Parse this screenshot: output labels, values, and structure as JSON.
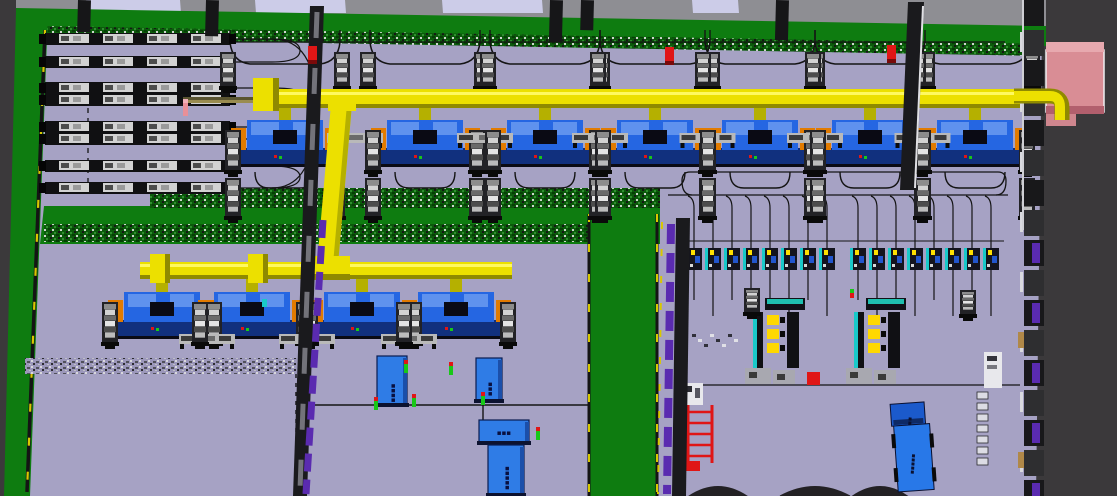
{
  "viewport": {
    "kind": "factory-3d-layout-render",
    "background": "#3b393b"
  },
  "labels": {
    "storage_box_1": "▪▪▪▪",
    "storage_box_2": "▪▪▪",
    "storage_box_3": "▪▪▪",
    "storage_box_4": "▪▪▪▪▪",
    "truck_cab": "▪▪",
    "truck_body": "▪▪▪▪▪"
  },
  "palette": {
    "bg": "#3b393b",
    "floor": "#a6a2c4",
    "green": "#0e7c10",
    "hedge": "#0b5a0b",
    "roof": "#8e8e93",
    "skylight": "#cccce8",
    "wallDark": "#1a1a1d",
    "wallLite": "#d9d9de",
    "purple": "#5a2bb0",
    "pipe": "#ece000",
    "pipeShade": "#8f8a00",
    "pipeDark": "#b5b000",
    "beam": "#9a8c50",
    "blue": "#2566e2",
    "blueLite": "#5f92ee",
    "blueDark": "#11307e",
    "navy": "#0a0a14",
    "orange": "#e27b00",
    "silver": "#d2d2d2",
    "silverMid": "#8c8c8c",
    "silverDark": "#4c4c4c",
    "red": "#e01616",
    "pinkFace": "#d98d95",
    "pinkTop": "#e7a9af",
    "pinkSide": "#b25f6d",
    "teal": "#1fbfae",
    "cyan": "#19c9c9",
    "track": "#141414",
    "yellowDash": "#d8c800",
    "boxBlue": "#2f7ce6",
    "boxBlueDark": "#1b4faa",
    "truckBlue": "#2878e8",
    "truckCab": "#1b5acc",
    "tan": "#b08848",
    "gray": "#73737a",
    "mound": "#232124",
    "figGreen": "#18c818",
    "figPink": "#e89098",
    "white": "#e8e8ec"
  },
  "scene": {
    "skylights": [
      [
        86,
        94
      ],
      [
        255,
        90
      ],
      [
        442,
        100
      ],
      [
        692,
        46
      ]
    ],
    "columns": [
      [
        78,
        32
      ],
      [
        206,
        36
      ],
      [
        550,
        42
      ],
      [
        581,
        30
      ],
      [
        776,
        40
      ]
    ],
    "line1": {
      "x1": 183,
      "x2": 1040,
      "pipeY": 89,
      "pipeH": 19,
      "beamY": 99,
      "riserX": 253,
      "stations": [
        285,
        425,
        545,
        655,
        760,
        870,
        975
      ]
    },
    "line2": {
      "x1": 140,
      "x2": 512,
      "pipeY": 262,
      "pipeH": 17,
      "beamY": 272,
      "risers": [
        150,
        248
      ],
      "stations": [
        162,
        252,
        362,
        456
      ]
    },
    "vpipe": {
      "top": [
        331,
        104
      ],
      "bot": [
        316,
        276
      ],
      "w": 21
    },
    "racks": {
      "x": 45,
      "w": 185,
      "rows": [
        33,
        56,
        82,
        94,
        121,
        133,
        160,
        182
      ]
    },
    "smallRow": {
      "y": 248,
      "h": 22,
      "groups": [
        {
          "x0": 686,
          "n": 8,
          "dx": 19
        },
        {
          "x0": 850,
          "n": 8,
          "dx": 19
        }
      ]
    },
    "cells": [
      {
        "x": 747,
        "red": true
      },
      {
        "x": 848,
        "red": false
      }
    ],
    "loneRobots": [
      [
        752,
        288
      ],
      [
        968,
        290
      ]
    ],
    "fireboxes": [
      [
        308,
        46
      ],
      [
        665,
        47
      ],
      [
        887,
        45
      ]
    ],
    "figures": [
      [
        404,
        360
      ],
      [
        449,
        362
      ],
      [
        412,
        394
      ],
      [
        374,
        397
      ],
      [
        481,
        392
      ],
      [
        536,
        427
      ]
    ],
    "pinkFigure": [
      183,
      103
    ],
    "tealFigure": [
      262,
      299
    ],
    "boxes": [
      {
        "x": 377,
        "y": 356,
        "w": 30,
        "h": 50,
        "vert": true,
        "bind": "labels.storage_box_1"
      },
      {
        "x": 476,
        "y": 358,
        "w": 26,
        "h": 44,
        "vert": true,
        "bind": "labels.storage_box_2"
      },
      {
        "x": 479,
        "y": 420,
        "w": 50,
        "h": 24,
        "vert": false,
        "bind": "labels.storage_box_3"
      },
      {
        "x": 488,
        "y": 445,
        "w": 36,
        "h": 51,
        "vert": true,
        "bind": "labels.storage_box_4"
      }
    ],
    "truck": {
      "x": 893,
      "y": 403,
      "rot": -4
    },
    "mounds": [
      [
        718,
        58
      ],
      [
        815,
        70
      ],
      [
        880,
        55
      ]
    ],
    "pinkBox": {
      "x": 1046,
      "y": 42,
      "w": 58,
      "h": 70
    },
    "redFrame": {
      "x": 687,
      "y": 405,
      "w": 26,
      "h": 58
    },
    "itemsColumn": {
      "x": 977,
      "y0": 392,
      "n": 7,
      "dy": 11
    }
  }
}
